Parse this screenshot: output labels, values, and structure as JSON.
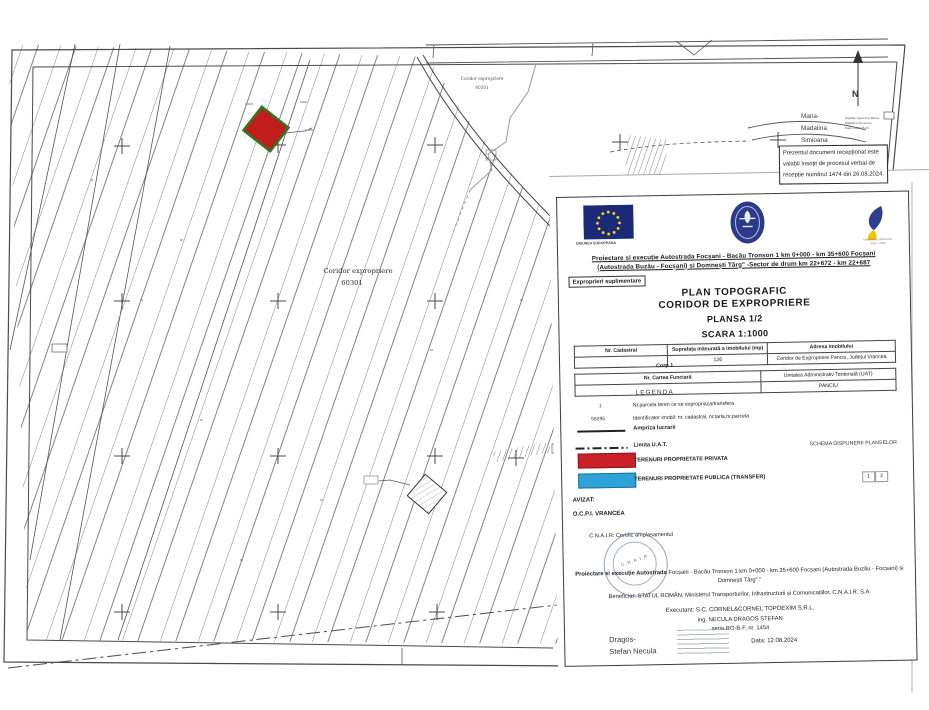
{
  "map": {
    "corridor_label": {
      "line1": "Coridor expropriere",
      "line2": "60301"
    },
    "corridor_label_small": {
      "line1": "Coridor expropriere",
      "line2": "60301"
    },
    "north_label": "N",
    "signer": {
      "line1": "Maria-",
      "line2": "Madalina",
      "line3": "Simioana",
      "digital_line1": "Digitally signed by Maria-",
      "digital_line2": "Madalina Simioana",
      "digital_line3": "Date: 2024.08.26"
    },
    "reception_note": {
      "line1": "Prezentul document recepționat este",
      "line2": "valabil însoțit de procesul verbal de",
      "line3": "recepție numărul 1474 din 26.08.2024."
    }
  },
  "title_block": {
    "eu_caption": "UNIUNEA EUROPEANA",
    "program_caption1": "Instrumente Structurale",
    "program_caption2": "2014 - 2020",
    "project_line1": "Proiectare si execuție Autostrada Focșani - Bacău Tronson 1 km 0+000 - km 35+600 Focșani",
    "project_line2": "(Autostrada Buzău - Focșani) si Domnești Târg\" -Sector de drum km  22+672 - km 22+687",
    "expro_box": "Exproprieri suplimentare",
    "plan_title_1": "PLAN TOPOGRAFIC",
    "plan_title_2": "CORIDOR DE EXPROPRIERE",
    "plansa": "PLANSA 1/2",
    "scara": "SCARA 1:1000",
    "table1": {
      "h1": "Nr. Cadastral",
      "h2": "Suprafața măsurată a imobilului (mp)",
      "h3": "Adresa imobilului",
      "v2": "126",
      "v3": "Coridor de Expropriere Panciu, Județul Vrancea",
      "corp": "Corp 1"
    },
    "table2": {
      "h1": "Nr. Cartea Funciară",
      "h2": "Unitatea Administrativ Teritorială (UAT)",
      "v2": "PANCIU"
    },
    "legend": {
      "title": "LEGENDA",
      "item1_key": "1",
      "item1_label": "Nr.parcela teren ce se expropriaza/transfera",
      "item2_key": "58295",
      "item2_label": "Identificator imobil: nr. cadastral, nr.tarla,nr.parcela",
      "item3_label": "Ampriza lucrarii",
      "item4_label": "Limita U.A.T.",
      "item5_label": "TERENURI PROPRIETATE PRIVATA",
      "item6_label": "TERENURI PROPRIETATE PUBLICA (TRANSFER)"
    },
    "schema": {
      "title": "SCHEMA DISPUNERII PLANSELOR",
      "cell1": "1",
      "cell2": "2"
    },
    "avizat": "AVIZAT:",
    "avizat_org": "O.C.P.I. VRANCEA",
    "cnair_cert": "C.N.A.I.R: Certific amplasamentul",
    "stamp_text": "C.N.A.I.R.",
    "footer_bold": "Proiectare si execuție Autostrada",
    "footer_rest1": " Focșani - Bacău Tronson 1 km 0+000 - km 35+600 Focșani (Autostrada Buzău - Focșani) si",
    "footer_line2": "Domnești Târg\" \"",
    "beneficiar": "Beneficiar: STATUL ROMÂN, Ministerul Transporturilor, Infrastructurii și Comunicațiilor, C.N.A.I.R. S.A.",
    "executant": "Executant: S.C. CORNEL&CORNEL TOPOEXIM S.R.L.",
    "executant_ing": "ing. NECULA DRAGOS STEFAN",
    "executant_seria": "seria RO-B-F, nr. 1454",
    "signer_line1": "Dragos-",
    "signer_line2": "Stefan Necula",
    "date": "Data: 12.08.2024"
  },
  "colors": {
    "private_red": "#c9202a",
    "public_blue": "#2fa3d9",
    "eu_blue": "#1b2a78",
    "stamp_blue": "#5b74b4"
  }
}
